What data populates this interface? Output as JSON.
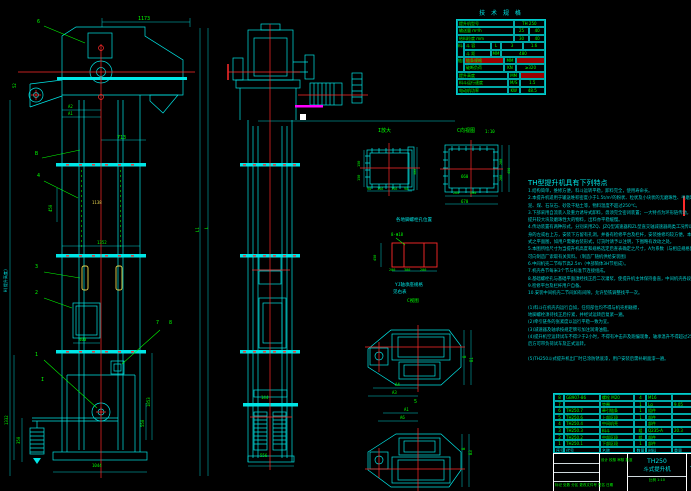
{
  "colors": {
    "background": "#000000",
    "structure_cyan": "#00e5e5",
    "dimension_green": "#00ff00",
    "centerline_red": "#ff2a2a",
    "bucket_yellow": "#e8d44d",
    "accent_magenta": "#ff00ff",
    "titleblock_white": "#ffffff",
    "highlight_red": "#9b0000"
  },
  "spec": {
    "title": "技 术 规 格",
    "rows": [
      [
        "提升机型号",
        "TH 250"
      ],
      [
        "输送量 m³/h",
        "25",
        "40"
      ],
      [
        "给料粒度 mm",
        "30",
        "40"
      ],
      [
        "料斗",
        "斗 容",
        "L",
        "3",
        "1.6"
      ],
      [
        "斗 距",
        "MM",
        "480"
      ],
      [
        "链条",
        "链条规格",
        "MM",
        ""
      ],
      [
        "破断负荷",
        "KN",
        "≥320"
      ],
      [
        "提升高度",
        "MM",
        ""
      ],
      [
        "料斗运行速度",
        "M/S",
        "1.5"
      ],
      [
        "电动机功率",
        "KW",
        "48.5"
      ]
    ]
  },
  "notes": {
    "heading": "TH型提升机具有下列特点",
    "lines": [
      "1.结构简单，维修方便，料斗运转平稳，卸料完全，使用寿命长。",
      "2.本提升机适用于输送堆积密度小于1.5t/m³的粉状、粒状及小块状的无磨琢性、半磨琢性物料，如水",
      "  泥、煤、石灰石、砂及干粘土等，物料温度不超过250℃。",
      "3.下部采用自流装入及重力诱导式卸料，毋须完全密闭装置；一大特点为环形链传动，运行平稳，适于",
      "  提升较大块及磨琢性大的物料，出料亦平稳缓慢。",
      "4.传动装置有两种形式，分别采用ZQ、JZQ型减速器和ZL型直交轴减速器两类工况传动装置，布置于机",
      "  身的左或右上方，安装下方留有孔洞，并备有检修平台及栏杆，安装维修均较方便。本图仅绘出左装形",
      "  式之平面图，如用户需要右装形式，订货时请予以注明，下图略有改动之处。",
      "5.本图所绘尺寸为当提升机高度和规格选定后查表确定之尺寸，A为系数（与相应规格配套的尺寸），也",
      "  可向制造厂索取有关资料。（制造厂随机供给安装图）",
      "6.中间机壳二节每节高2.5m（中部筒体3H节组成）。",
      "7.机壳各节每米3个节与标准节连接组成。",
      "8.基础螺栓孔与基础平面须经找正后二次灌浆，使提升机主体保持垂直，中间机壳各段采用橡胶垫密封连接。",
      "9.检修平台及栏杆用户自备。",
      "10.安装中间机壳二节间如有间隙，允许垫铁调整找平一次。",
      "",
      "(1)料斗在机壳内运行自如，任何部位均不得与机壳相碰擦，",
      "  地脚螺栓须待找正后拧紧，并经试运转后复紧一遍。",
      "(2)牵引链条的张紧度以运行平稳一致为宜。",
      "(3)减速器及轴承按规定牌号加注润滑油脂。",
      "(4)提升机空运转试车不得少于2小时，不得有冲击声及跑偏现象，轴承温升不得超过25℃，试车正常",
      "  后方可带负荷试车及正式运转。",
      "",
      "(5)TH250斗式提升机出厂时已涂防锈底漆，用户安装后需补刷面漆一遍。"
    ]
  },
  "bom": {
    "rows": [
      [
        "8",
        "GB907-86",
        "螺栓 M20",
        "4",
        "M16",
        ""
      ],
      [
        "7",
        "",
        "垫圈",
        "1",
        "Lg",
        "9.05"
      ],
      [
        "6",
        "TH250.7",
        "牵引链条",
        "1",
        "组件",
        ""
      ],
      [
        "5",
        "TH250.6",
        "上部区段",
        "1",
        "部件",
        ""
      ],
      [
        "4",
        "TH250.4",
        "中间机壳",
        "",
        "部件",
        ""
      ],
      [
        "3",
        "TH250.3",
        "料斗",
        "组",
        "Q235-A",
        "20.3"
      ],
      [
        "2",
        "TH250.2",
        "中部区段",
        "组",
        "部件",
        ""
      ],
      [
        "1",
        "TH250.1",
        "下部区段",
        "1",
        "部件",
        ""
      ],
      [
        "序号",
        "代号",
        "名称",
        "数量",
        "材料",
        "重量"
      ]
    ]
  },
  "title_block": {
    "model": "TH250",
    "product": "斗式提升机",
    "drawing_no": "TH250",
    "scale_row": "比例 1:10",
    "revision_row": "标记 处数 分区 更改文件号 签名 日期",
    "sign_row": "设计 校核 审核 批准"
  },
  "dims": {
    "h1173": "1173",
    "lead6": "6",
    "d52": "52",
    "a2": "A2",
    "a1": "A1",
    "d713": "713",
    "lblB": "B",
    "lbl4": "4",
    "d450": "450",
    "d1138": "1138",
    "d1352": "1352",
    "lbl3": "3",
    "lbl2": "2",
    "d400": "400",
    "lbl7": "7",
    "lbl8": "8",
    "lbl1": "1",
    "sectI": "I",
    "d1332": "1332",
    "d350": "350",
    "d1853": "1853",
    "d550": "550",
    "dL1": "L1",
    "dL": "L",
    "dH": "H(提升高度)",
    "d1044": "1044",
    "d144": "144",
    "d556": "556",
    "tI": "I放大",
    "i150a": "150",
    "i150b": "150",
    "i300": "300",
    "i90a": "90",
    "i156a": "156",
    "i156b": "156",
    "i90b": "90",
    "tC": "C向视图",
    "sC": "1:10",
    "c660": "660",
    "c260": "260",
    "c200b": "200",
    "c670": "670",
    "c200r1": "200",
    "c200r2": "200",
    "c450": "450",
    "anch_cap": "各地脚螺栓孔位置",
    "anch_h": "8-Φ18",
    "anch450": "450",
    "anch200a": "200",
    "anch300": "300",
    "anch200b": "200",
    "brg1": "YJ轴承座规格",
    "brg2": "见右表",
    "cview": "C视图",
    "p1a4": "A4",
    "p1a3": "A3",
    "p1b": "B",
    "p1b1": "B1",
    "lbl5": "5",
    "p2a1": "A1",
    "p2a6": "A6",
    "p2b": "B",
    "p2b3": "B3"
  }
}
